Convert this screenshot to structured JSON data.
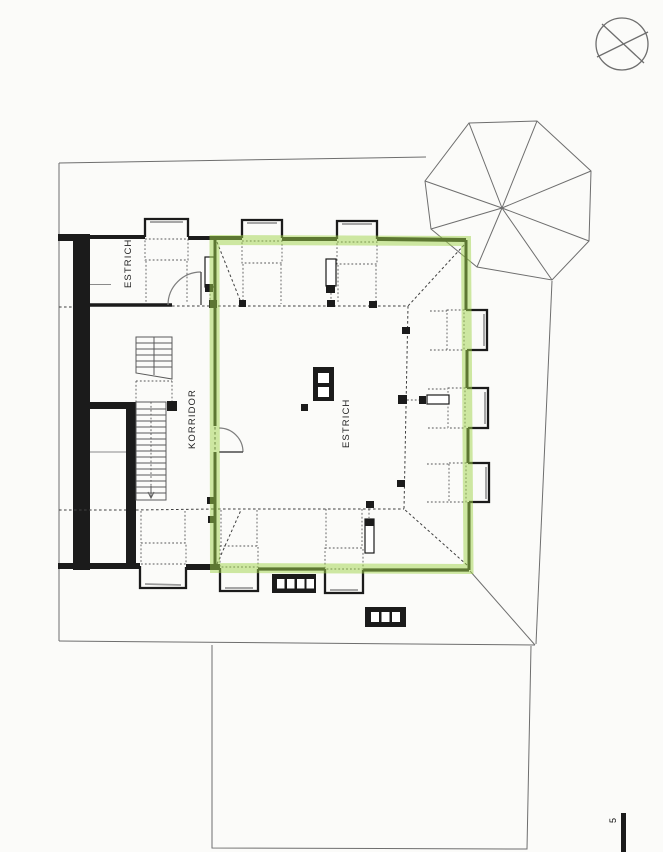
{
  "plan": {
    "labels": {
      "attic_left": "ESTRICH",
      "corridor": "KORRIDOR",
      "attic_main": "ESTRICH"
    },
    "page_marker": "5",
    "highlighted_room": "attic_main"
  },
  "colors": {
    "paper": "#fbfbf9",
    "ink": "#1b1b1b",
    "line": "#6e6e6e",
    "dash": "#3f3f3f",
    "window": "#9a9a9a",
    "highlight": "#9fd349"
  },
  "icons": {
    "north_indicator": "crossed-circle"
  }
}
